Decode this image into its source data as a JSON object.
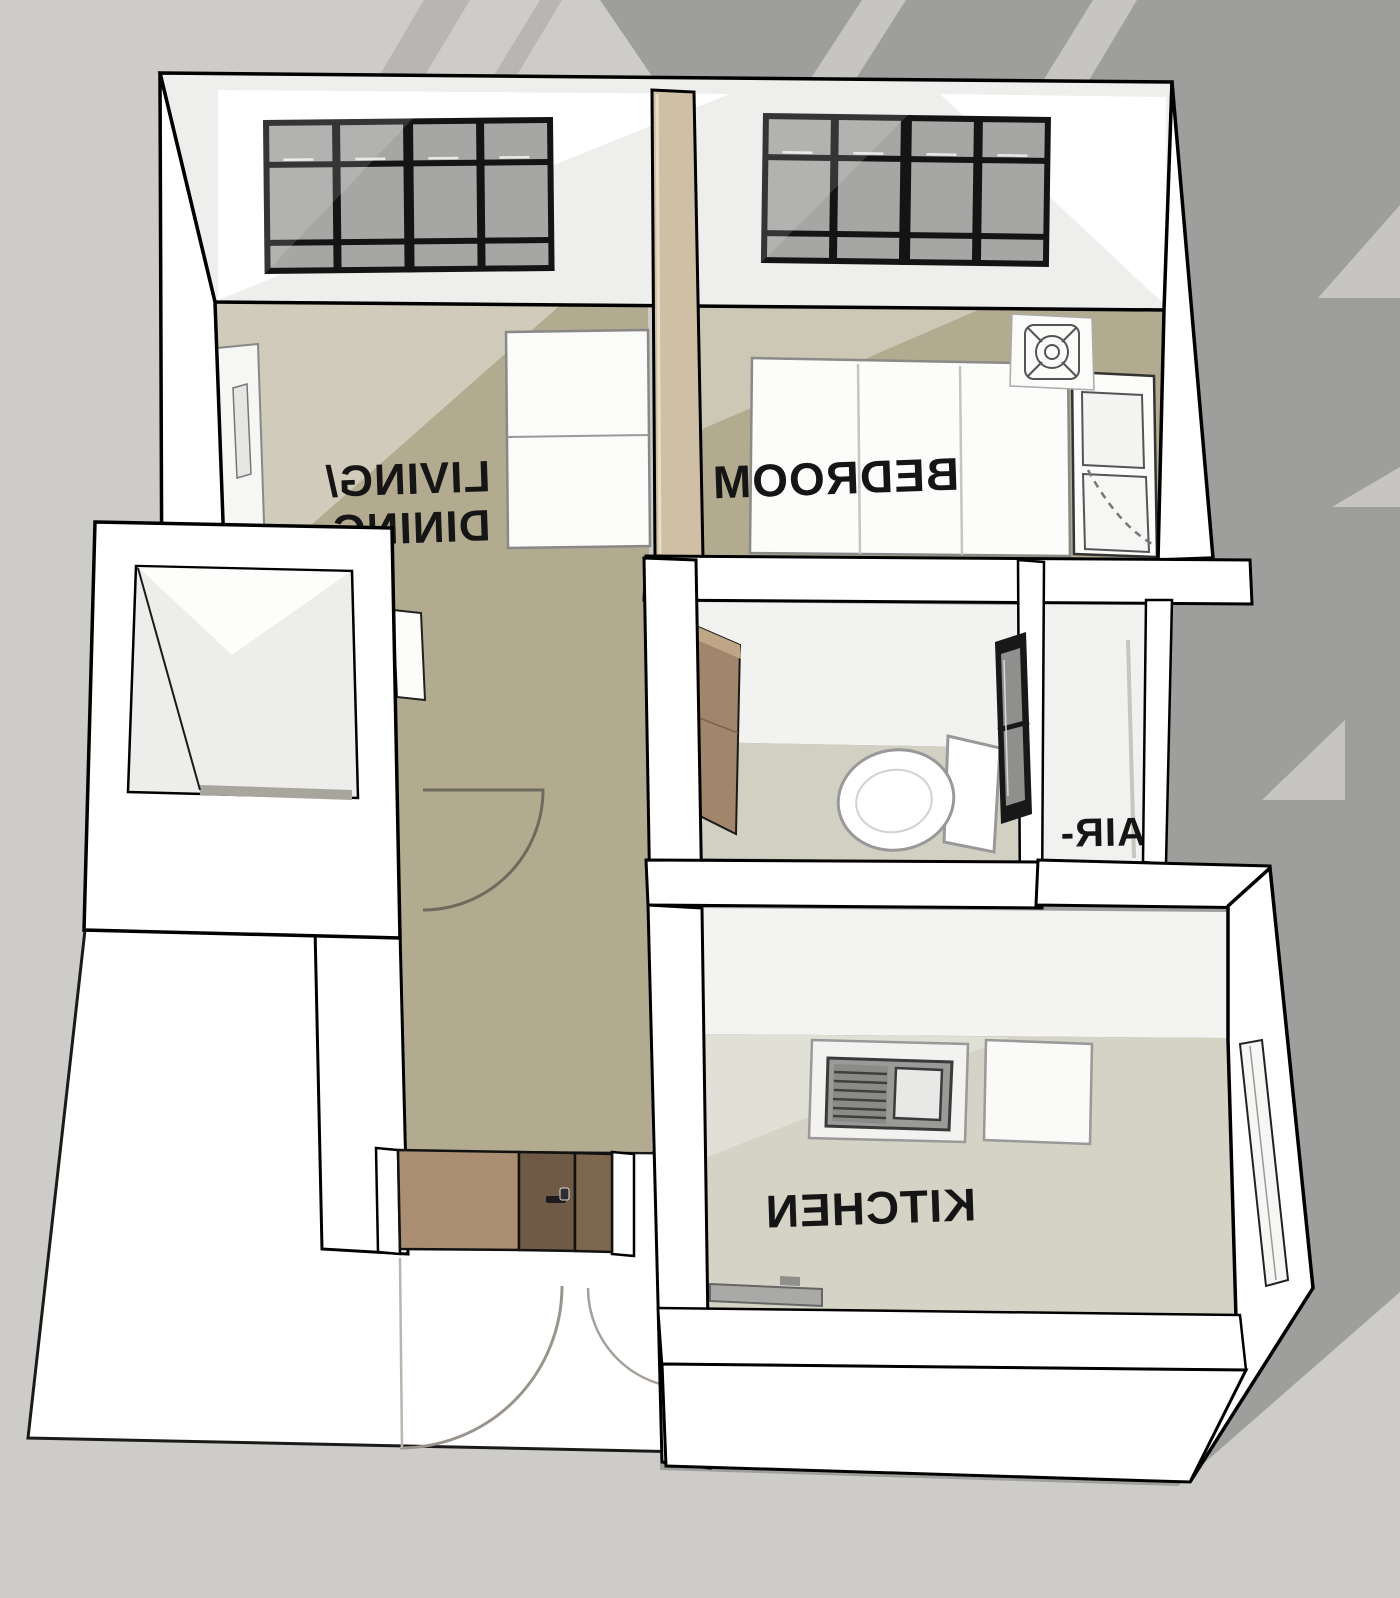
{
  "scene": {
    "description": "3D SketchUp-style bird's-eye floor plan of a small one-bedroom apartment; all room labels appear horizontally mirrored",
    "view": "isometric top-down",
    "text_mirrored": true
  },
  "colors": {
    "background_base": "#cdccc8",
    "background_dark_shape": "#9e9e9c",
    "background_light_shape": "#c6c5c1",
    "wall_fill": "#ffffff",
    "outline": "#000000",
    "floor_living_tan": "#b3ab90",
    "floor_wet_rooms": "#d5d3c5",
    "floor_balcony": "#ededeb",
    "divider_wall_tan": "#cfc0a5",
    "door_wood_light": "#a98e72",
    "door_wood_dark": "#6f5a45",
    "window_frame": "#141414",
    "window_glass": "#a6a6a4",
    "label_text": "#151515"
  },
  "rooms": {
    "living_dining": {
      "label_line1": "LIVING/",
      "label_line2": "DINING",
      "text_mirrored": true
    },
    "bedroom": {
      "label": "BEDROOM",
      "text_mirrored": true
    },
    "bathroom": {
      "label": "BATH",
      "text_mirrored": true,
      "partially_hidden_behind_wall": true
    },
    "aircon_ledge": {
      "label": "AIR-",
      "text_mirrored": true,
      "label_truncated": true
    },
    "kitchen": {
      "label": "KITCHEN",
      "text_mirrored": true
    },
    "balcony": {
      "label": ""
    },
    "hallway": {
      "label": ""
    }
  },
  "fixtures": [
    "living-window-grid",
    "bedroom-window-grid",
    "sofa-bed",
    "sideboard-cabinet",
    "double-bed",
    "wardrobe",
    "ceiling-fan-symbol",
    "toilet",
    "bathroom-cabinet",
    "bathroom-window",
    "kitchen-sink-stove-unit",
    "kitchen-counter-square",
    "kitchen-counter-rail",
    "kitchen-terrace-door",
    "entrance-door",
    "door-swing-arc-entrance",
    "door-swing-arc-hall"
  ]
}
